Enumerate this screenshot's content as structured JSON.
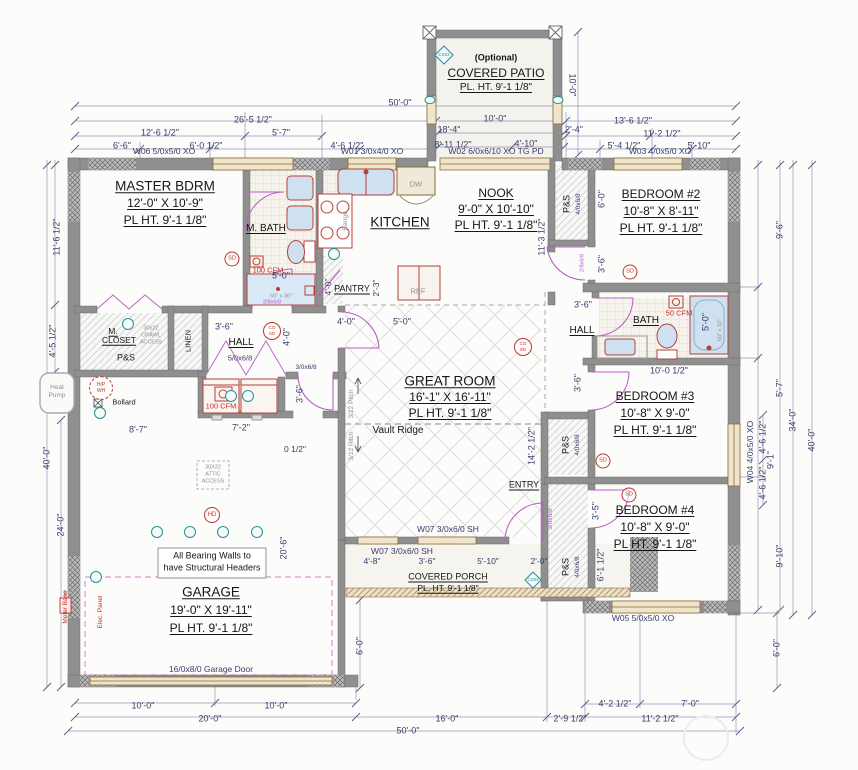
{
  "rooms": {
    "patio_tag": "(Optional)",
    "patio_name": "COVERED PATIO",
    "patio_ht": "PL. HT. 9'-1 1/8\"",
    "master_name": "MASTER BDRM",
    "master_size": "12'-0\" X 10'-9\"",
    "master_ht": "PL HT. 9'-1 1/8\"",
    "mbath": "M. BATH",
    "kitchen": "KITCHEN",
    "pantry": "PANTRY",
    "nook_name": "NOOK",
    "nook_size": "9'-0\" X 10'-10\"",
    "nook_ht": "PL HT. 9'-1 1/8\"",
    "bed2_name": "BEDROOM #2",
    "bed2_size": "10'-8\" X 8'-11\"",
    "bed2_ht": "PL HT. 9'-1 1/8\"",
    "bed3_name": "BEDROOM #3",
    "bed3_size": "10'-8\" X 9'-0\"",
    "bed3_ht": "PL HT. 9'-1 1/8\"",
    "bed4_name": "BEDROOM #4",
    "bed4_size": "10'-8\" X 9'-0\"",
    "bed4_ht": "PL HT. 9'-1 1/8\"",
    "great_name": "GREAT ROOM",
    "great_size": "16'-1\" X 16'-11\"",
    "great_ht": "PL HT. 9'-1 1/8\"",
    "garage_name": "GARAGE",
    "garage_size": "19'-0\" X 19'-11\"",
    "garage_ht": "PL HT. 9'-1 1/8\"",
    "porch_name": "COVERED PORCH",
    "porch_ht": "PL. HT. 9'-1 1/8\"",
    "mcloset1": "M.",
    "mcloset2": "CLOSET",
    "linen": "LINEN",
    "hall": "HALL",
    "bath": "BATH",
    "entry": "ENTRY",
    "ps": "P&S"
  },
  "windows": {
    "w01": "W01 3/0x4/0 XO",
    "w02": "W02 6/0x6/10 XO  TG PD",
    "w03": "W03 4/0x5/0 XO",
    "w04": "W04 4/0x5/0 XO",
    "w05": "W05 5/0x5/0 XO",
    "w06": "W06 5/0x5/0 XO",
    "w07": "W07 3/0x6/0 SH"
  },
  "doors": {
    "d5068": "5/0x6/8",
    "d3068": "3/0x6/8",
    "d2868": "2/8x6/8",
    "ps_size": "4/0x6/8",
    "garage_door": "16/0x8/0 Garage Door"
  },
  "labels": {
    "vault": "Vault Ridge",
    "pitch": "3/12 Pitch",
    "bearing1": "All Bearing Walls to",
    "bearing2": "have Structural Headers",
    "attic1": "30X22",
    "attic2": "ATTIC",
    "attic3": "ACCESS",
    "crawl1": "30x22",
    "crawl2": "CRAWL",
    "crawl3": "ACCESS",
    "cfm100": "100 CFM",
    "cfm50": "50 CFM",
    "shower_size": "60\" x 36\"",
    "tub_size": "60\" x 32\"",
    "ref": "REF",
    "dw": "DW",
    "range": "Range",
    "heat1": "Heat",
    "heat2": "Pump",
    "hpwh1": "H/P",
    "hpwh2": "WH",
    "bollard": "Bollard",
    "meter": "Meter Base",
    "elec": "Elec. Panel",
    "sd": "SD",
    "co": "CO",
    "hd": "HD",
    "cs02": "CS02",
    "cs03": "CS03"
  },
  "dims": {
    "t50": "50'-0\"",
    "t26": "26'-5 1/2\"",
    "t12": "12'-6 1/2\"",
    "t5_7": "5'-7\"",
    "t6_6": "6'-6\"",
    "t6_0": "6'-0 1/2\"",
    "t4_6": "4'-6 1/2\"",
    "t18": "18'-4\"",
    "t8_11": "8'-11 1/2\"",
    "t4_10": "4'-10\"",
    "t10": "10'-0\"",
    "t2_4": "2'-4\"",
    "t13": "13'-6 1/2\"",
    "t11": "11'-2 1/2\"",
    "t5_4": "5'-4 1/2\"",
    "t5_10": "5'-10\"",
    "patio_h": "10'-0\"",
    "l11_6": "11'-6 1/2\"",
    "l4_5": "4'-5 1/2\"",
    "l40": "40'-0\"",
    "l24": "24'-0\"",
    "r9_6": "9'-6\"",
    "r5_7": "5'-7\"",
    "r4_6a": "4'-6 1/2\"",
    "r9_1": "9'-1\"",
    "r4_6b": "4'-6 1/2\"",
    "r34": "34'-0\"",
    "r40": "40'-0\"",
    "r9_10": "9'-10\"",
    "r6_0": "6'-0\"",
    "b10a": "10'-0\"",
    "b10b": "10'-0\"",
    "b20": "20'-0\"",
    "b16": "16'-0\"",
    "b2_9": "2'-9 1/2\"",
    "b4_2": "4'-2 1/2\"",
    "b7_0": "7'-0\"",
    "b11_2": "11'-2 1/2\"",
    "b50": "50'-0\"",
    "b6_0": "6'-0\"",
    "s5_0": "5'-0\"",
    "k4_0": "4'-0\"",
    "k2_3": "2'-3\"",
    "g4_0": "4'-0\"",
    "g5_0": "5'-0\"",
    "h3_6": "3'-6\"",
    "h4_0": "4'-0\"",
    "h3_6b": "3'-6\"",
    "ga8_7": "8'-7\"",
    "ga7_2": "7'-2\"",
    "ga0_5": "0 1/2\"",
    "ga20_6": "20'-6\"",
    "n11_3": "11'-3 1/2\"",
    "n6_0": "6'-0\"",
    "n3_6": "3'-6\"",
    "rb3_6": "3'-6\"",
    "rb5_0": "5'-0\"",
    "rb3_6b": "3'-6\"",
    "b3_10": "10'-0 1/2\"",
    "gr14_2": "14'-2 1/2\"",
    "e3_5": "3'-5\"",
    "b4_6_1": "6'-1 1/2\"",
    "p4_8": "4'-8\"",
    "p3_6": "3'-6\"",
    "p5_10": "5'-10\"",
    "p2_0": "2'-0\"",
    "p6_0": "6'-0\""
  }
}
